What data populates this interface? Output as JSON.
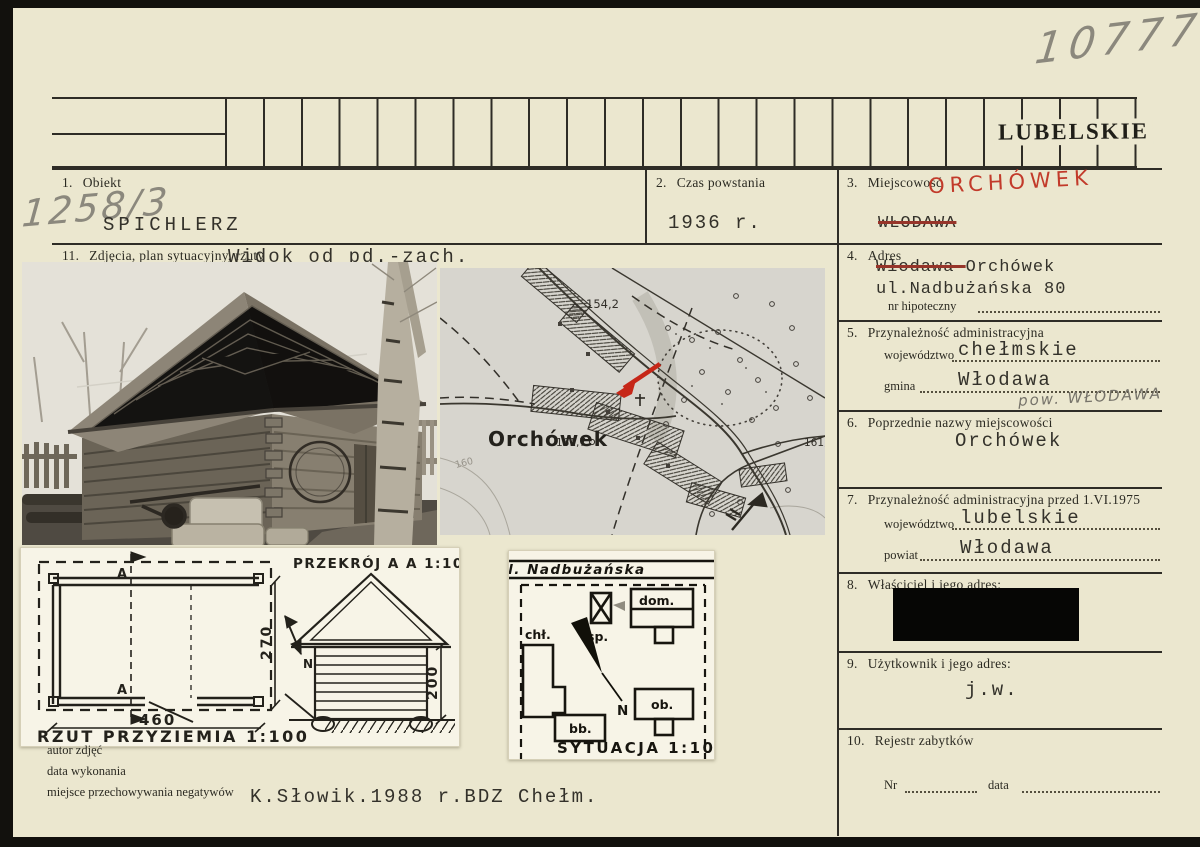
{
  "page": {
    "number": "10777",
    "stamp": "LUBELSKIE"
  },
  "fields": {
    "f1": {
      "num": "1.",
      "label": "Obiekt",
      "pencil": "1258/3",
      "value": "SPICHLERZ"
    },
    "f2": {
      "num": "2.",
      "label": "Czas powstania",
      "value": "1936 r."
    },
    "f3": {
      "num": "3.",
      "label": "Miejscowość",
      "red": "ORCHÓWEK",
      "crossed": "WŁODAWA"
    },
    "f4": {
      "num": "4.",
      "label": "Adres",
      "struck": "Włodawa-",
      "rest": "Orchówek",
      "line2": "ul.Nadbużańska 80",
      "hip": "nr hipoteczny"
    },
    "f5": {
      "num": "5.",
      "label": "Przynależność administracyjna",
      "woj_label": "województwo",
      "woj": "chełmskie",
      "gmina_label": "gmina",
      "gmina": "Włodawa",
      "pencil": "pow. WŁODAWA"
    },
    "f6": {
      "num": "6.",
      "label": "Poprzednie nazwy miejscowości",
      "value": "Orchówek"
    },
    "f7": {
      "num": "7.",
      "label": "Przynależność administracyjna przed 1.VI.1975",
      "woj_label": "województwo",
      "woj": "lubelskie",
      "powiat_label": "powiat",
      "powiat": "Włodawa"
    },
    "f8": {
      "num": "8.",
      "label": "Właściciel i jego adres:"
    },
    "f9": {
      "num": "9.",
      "label": "Użytkownik i jego adres:",
      "value": "j.w."
    },
    "f10": {
      "num": "10.",
      "label": "Rejestr zabytków",
      "nr": "Nr",
      "data": "data"
    },
    "f11": {
      "num": "11.",
      "label": "Zdjęcia, plan sytuacyjny, rzuty",
      "caption": "Widok od pd.-zach."
    }
  },
  "map": {
    "town": "Orchówek",
    "spot1": "154,2",
    "spot2": "161,7",
    "spot3": "161,5",
    "contour": "160"
  },
  "drawings": {
    "plan": {
      "title": "RZUT PRZYZIEMIA 1:100",
      "width": "460",
      "height": "270",
      "a": "A",
      "north": "N"
    },
    "section": {
      "title": "PRZEKRÓJ A A 1:100",
      "height": "200"
    },
    "site": {
      "title": "SYTUACJA 1:1000",
      "street": "ul. Nadbużańska",
      "sp": "sp.",
      "dom": "dom.",
      "chl": "chł.",
      "bb": "bb.",
      "ob": "ob.",
      "north": "N"
    }
  },
  "footer": {
    "author": "autor zdjęć",
    "date": "data wykonania",
    "negatives": "miejsce przechowywania negatywów",
    "credit": "K.Słowik.1988 r.BDZ Chełm."
  }
}
